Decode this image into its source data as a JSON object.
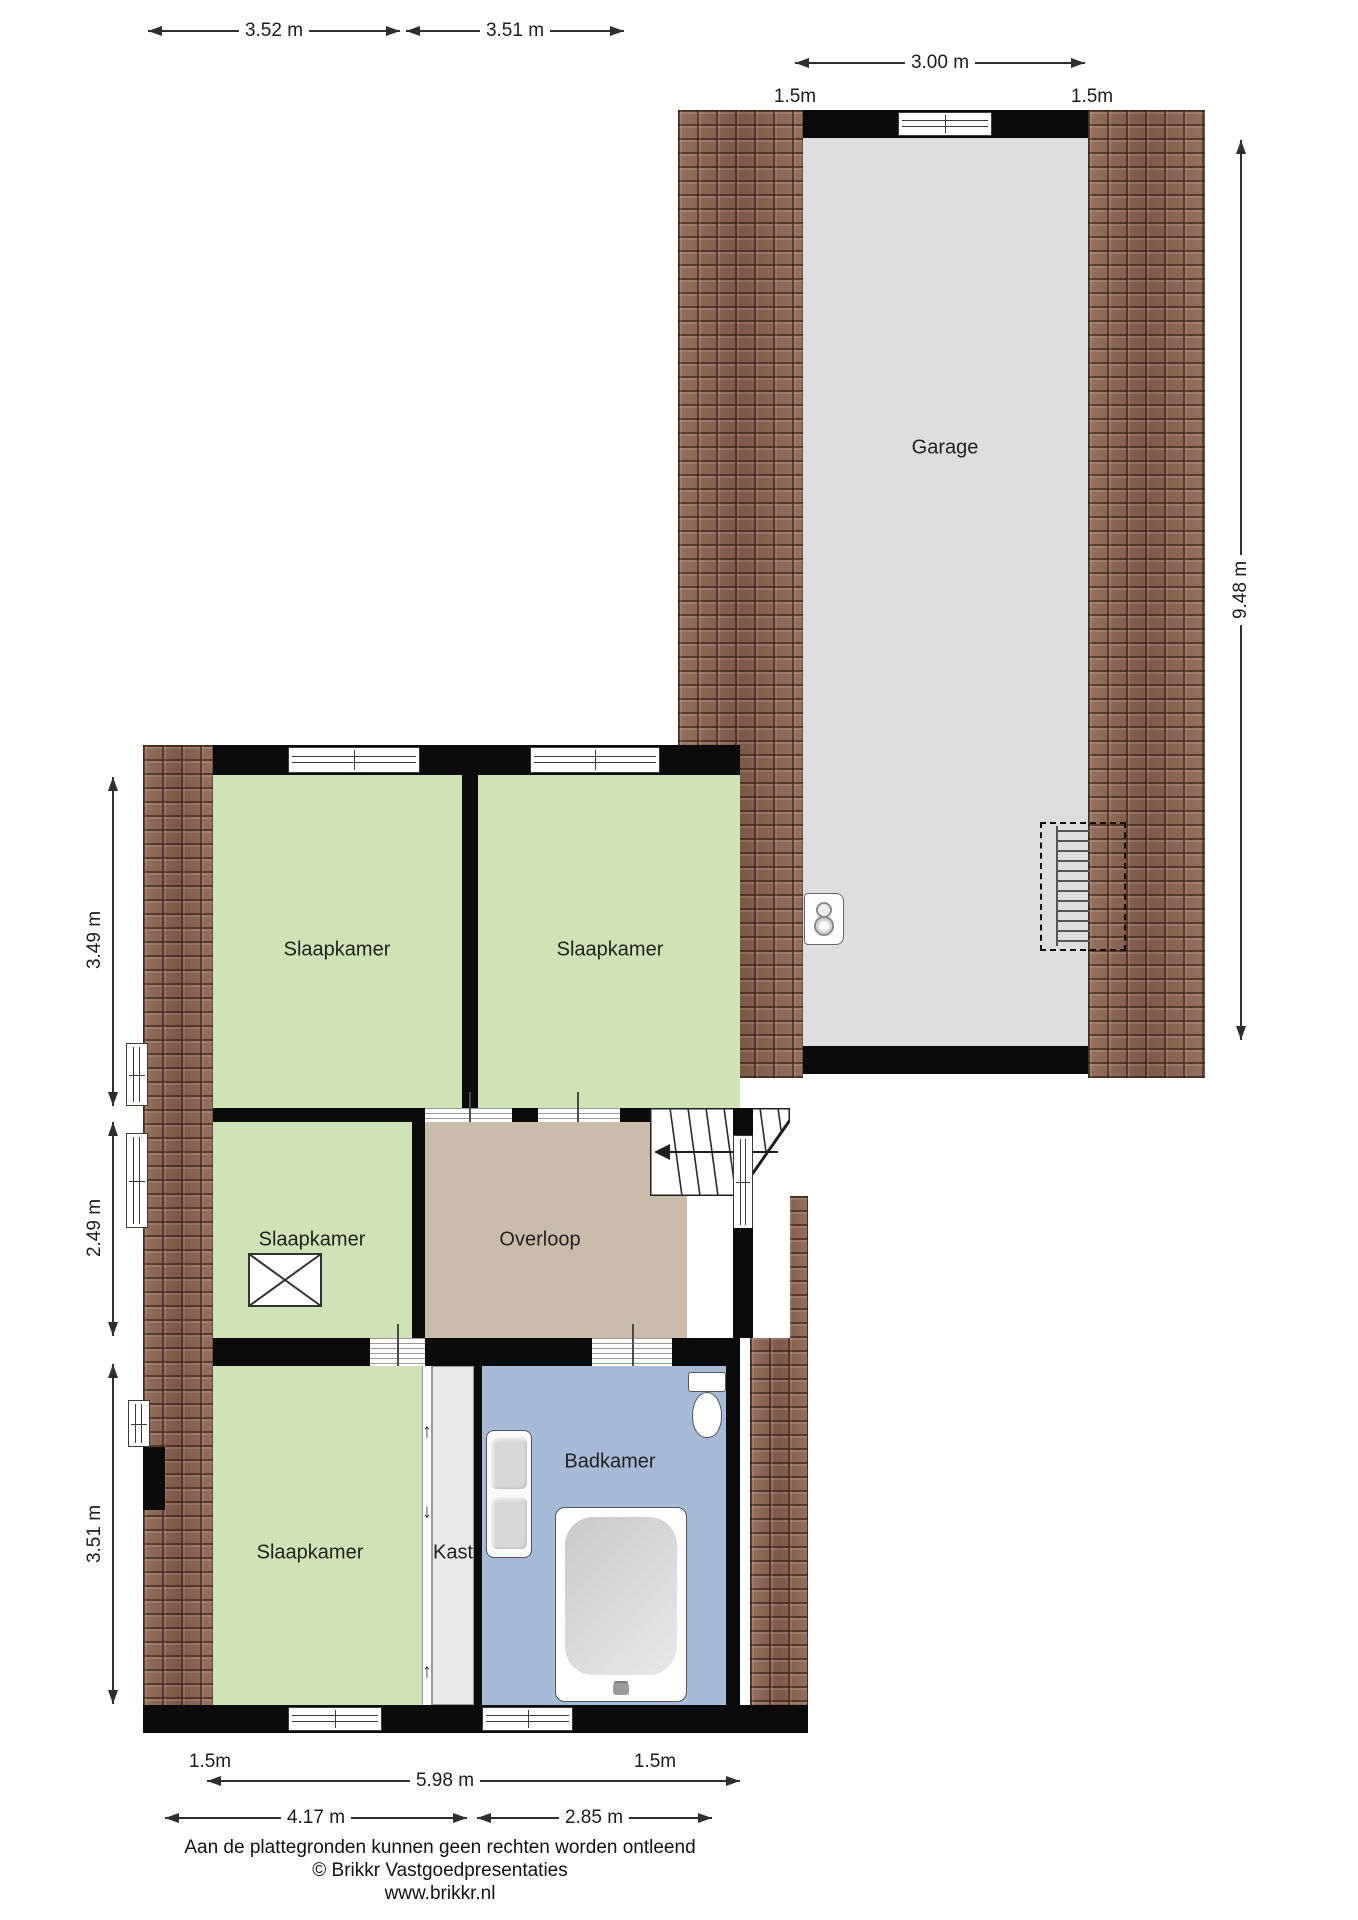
{
  "colors": {
    "wall": "#0b0b0b",
    "bedroom_green": "#cfe3b6",
    "hall_tan": "#c9bcaa",
    "bathroom_blue": "#a7bad7",
    "garage_gray": "#dedede",
    "roof_brown": "#8d6554"
  },
  "rooms": [
    {
      "id": "slaapkamer-top-left",
      "label": "Slaapkamer"
    },
    {
      "id": "slaapkamer-top-right",
      "label": "Slaapkamer"
    },
    {
      "id": "slaapkamer-middle-left",
      "label": "Slaapkamer"
    },
    {
      "id": "slaapkamer-bottom-left",
      "label": "Slaapkamer"
    },
    {
      "id": "overloop",
      "label": "Overloop"
    },
    {
      "id": "kast",
      "label": "Kast"
    },
    {
      "id": "badkamer",
      "label": "Badkamer"
    },
    {
      "id": "garage",
      "label": "Garage"
    }
  ],
  "dims": {
    "house_top": [
      {
        "label": "3.52 m"
      },
      {
        "label": "3.51 m"
      }
    ],
    "garage_top": {
      "width": "3.00 m",
      "overhang_left": "1.5m",
      "overhang_right": "1.5m"
    },
    "garage_side": {
      "depth": "9.48 m"
    },
    "house_left": [
      {
        "label": "3.49 m"
      },
      {
        "label": "2.49 m"
      },
      {
        "label": "3.51 m"
      }
    ],
    "house_bottom": {
      "overhang_left": "1.5m",
      "total": "5.98 m",
      "segment_left": "4.17 m",
      "segment_right": "2.85 m",
      "overhang_right": "1.5m"
    }
  },
  "footer": {
    "disclaimer": "Aan de plattegronden kunnen geen rechten worden ontleend",
    "copyright": "© Brikkr Vastgoedpresentaties",
    "website": "www.brikkr.nl"
  }
}
